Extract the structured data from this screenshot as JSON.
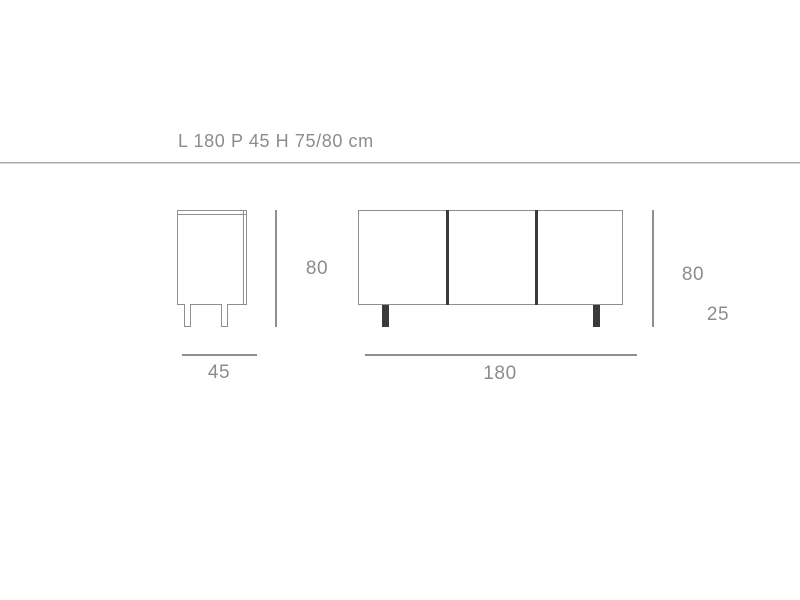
{
  "title": "L 180 P 45 H 75/80 cm",
  "drawing": {
    "side_view": {
      "height_dim": "80",
      "width_dim": "45",
      "legs_visible": 2
    },
    "front_view": {
      "width_dim": "180",
      "height_dim": "80",
      "leg_dim": "25",
      "door_count": 3,
      "legs_visible": 2
    }
  },
  "colors": {
    "background": "#ffffff",
    "text": "#8c8c8c",
    "outline": "#8f8f8f",
    "dark_detail": "#3a3a3a",
    "separator": "#a9a9a9"
  }
}
